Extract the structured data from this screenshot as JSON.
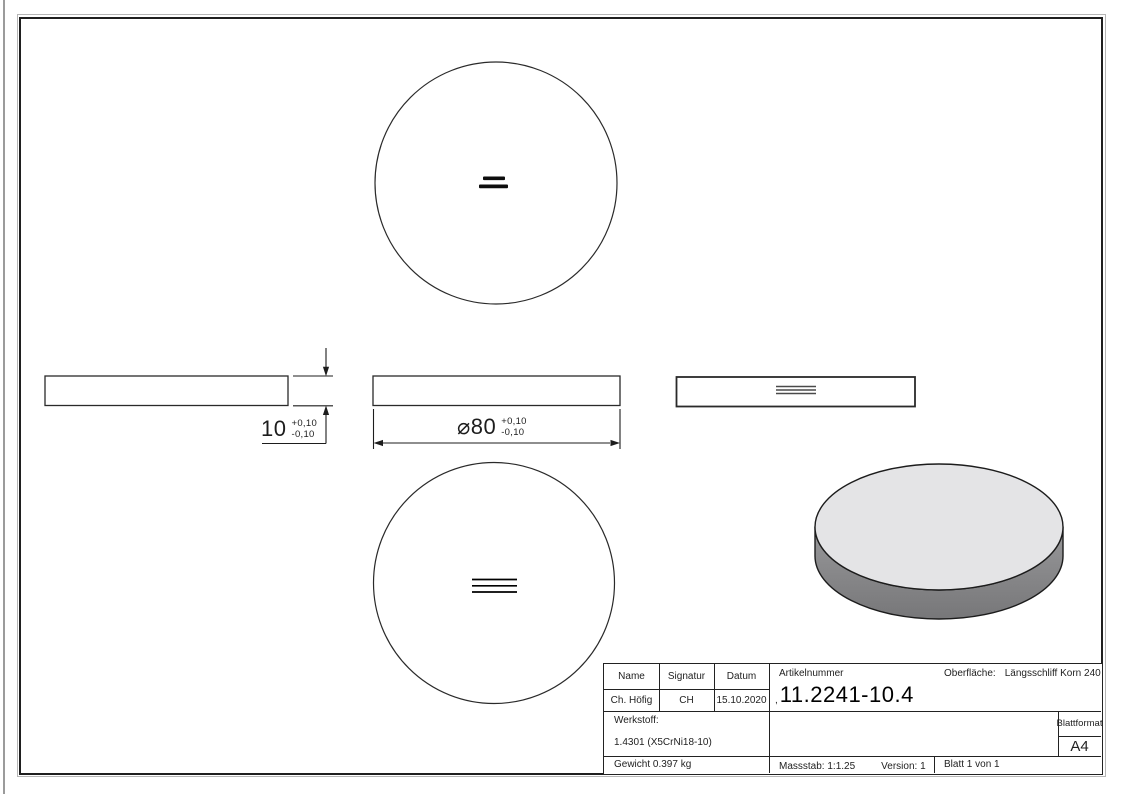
{
  "colors": {
    "line": "#2a2a2a",
    "disc_top_face": "#e4e4e6",
    "disc_side_light": "#98989a",
    "disc_side_dark": "#777779"
  },
  "dimensions": {
    "thickness": {
      "value": "10",
      "tol_plus": "+0,10",
      "tol_minus": "-0,10"
    },
    "diameter": {
      "symbol_and_value": "⌀80",
      "tol_plus": "+0,10",
      "tol_minus": "-0,10"
    }
  },
  "title_block": {
    "name_label": "Name",
    "signatur_label": "Signatur",
    "datum_label": "Datum",
    "name_value": "Ch. Höfig",
    "signatur_value": "CH",
    "datum_value": "15.10.2020",
    "artikelnummer_label": "Artikelnummer",
    "artikelnummer_prefix": ",",
    "artikelnummer_value": "11.2241-10.4",
    "oberflaeche_label": "Oberfläche:",
    "oberflaeche_value": "Längsschliff Korn 240",
    "werkstoff_label": "Werkstoff:",
    "werkstoff_value": "1.4301 (X5CrNi18-10)",
    "blattformat_label": "Blattformat",
    "blattformat_value": "A4",
    "gewicht": "Gewicht 0.397 kg",
    "massstab": "Massstab: 1:1.25",
    "version": "Version: 1",
    "blatt": "Blatt 1 von 1"
  }
}
